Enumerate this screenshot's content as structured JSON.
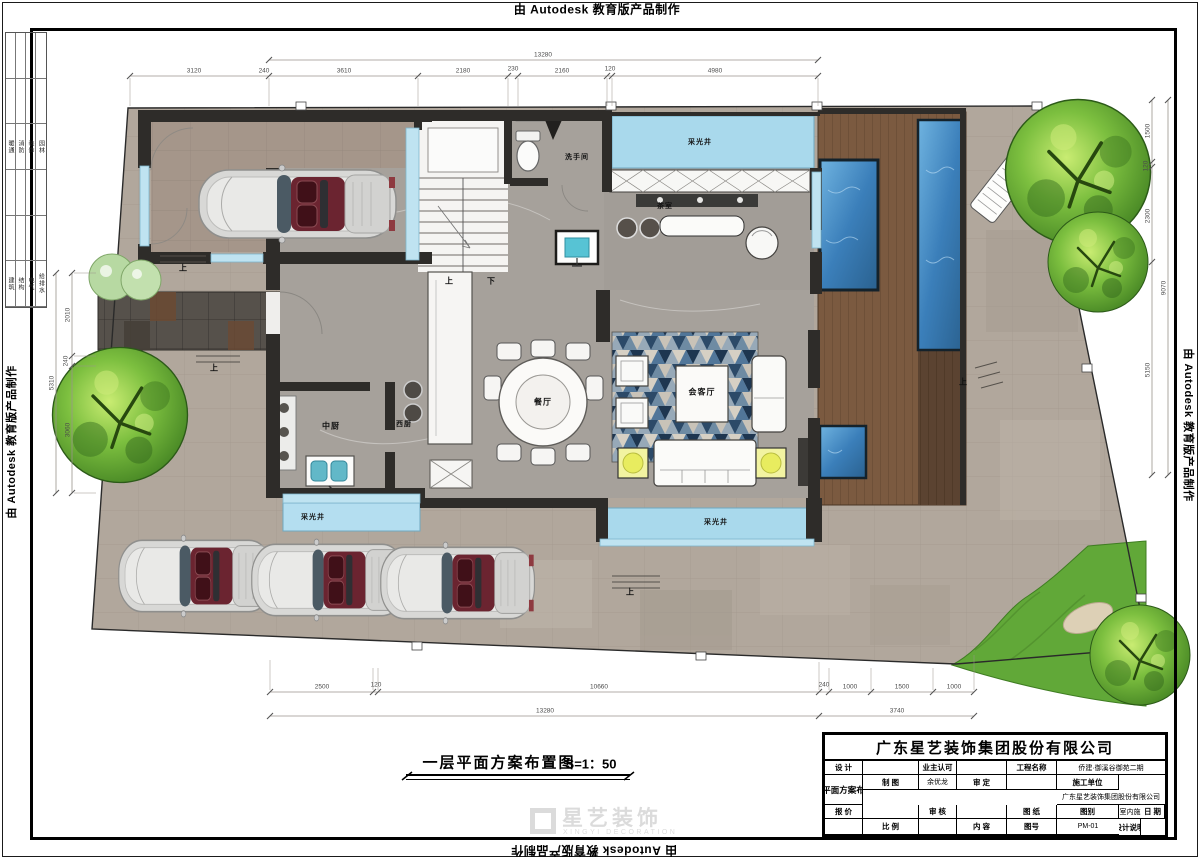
{
  "stamp": {
    "autodesk": "由 Autodesk 教育版产品制作"
  },
  "margin_table": {
    "group1": [
      "暖通",
      "消防",
      "装饰",
      "园林"
    ],
    "group2": [
      "建筑",
      "结构",
      "电气",
      "给排水"
    ]
  },
  "plan": {
    "labels": {
      "skylight_top": "采光井",
      "skylight_bottom_left": "采光井",
      "skylight_bottom_mid": "采光井",
      "bathroom": "洗手间",
      "tea_room": "茶室",
      "dining": "餐厅",
      "living": "会客厅",
      "kitchen_cn": "中厨",
      "kitchen_west": "西厨",
      "up": "上",
      "down": "下"
    },
    "dims": {
      "top_total": "13280",
      "top": [
        "3120",
        "240",
        "3610",
        "2180",
        "230",
        "2160",
        "120",
        "4980"
      ],
      "bottom": [
        "2500",
        "120",
        "10660",
        "240",
        "1000",
        "1500",
        "1000"
      ],
      "bottom_total_left": "13280",
      "bottom_total_right": "3740",
      "left": [
        "2010",
        "240",
        "3060"
      ],
      "left_total": "5310",
      "right": [
        "1500",
        "120",
        "2300",
        "5150"
      ],
      "right_total": "9070"
    },
    "caption": {
      "title": "一层平面方案布置图",
      "scale": "S=1：50"
    }
  },
  "watermark": {
    "cn": "星艺装饰",
    "en": "XINGYI DECORATION"
  },
  "title_block": {
    "company": "广东星艺装饰集团股份有限公司",
    "design_label": "设 计",
    "design_value": "",
    "draft_label": "制 图",
    "draft_value": "余优龙",
    "quote_label": "报 价",
    "quote_value": "",
    "date_label": "日 期",
    "date_value": "",
    "owner_label": "业主认可",
    "owner_value": "",
    "approve_label": "审 定",
    "approve_value": "",
    "check_label": "审 核",
    "check_value": "",
    "scale_label": "比 例",
    "scale_value": "",
    "project_label": "工程名称",
    "project_value": "侨建·御溪谷御苑二期",
    "contractor_label": "施工单位",
    "contractor_value": "广东星艺装饰集团股份有限公司",
    "sheet_label": "图 纸",
    "content_label": "内 容",
    "sheet_value": "一层平面方案布置图",
    "category_label": "图别",
    "category_value": "室内施",
    "number_label": "图号",
    "number_value": "PM-01",
    "note_label": "设计说明",
    "permit_label": "施工图审查许可证编号：",
    "permit_value": "A144016621(甲级)"
  }
}
